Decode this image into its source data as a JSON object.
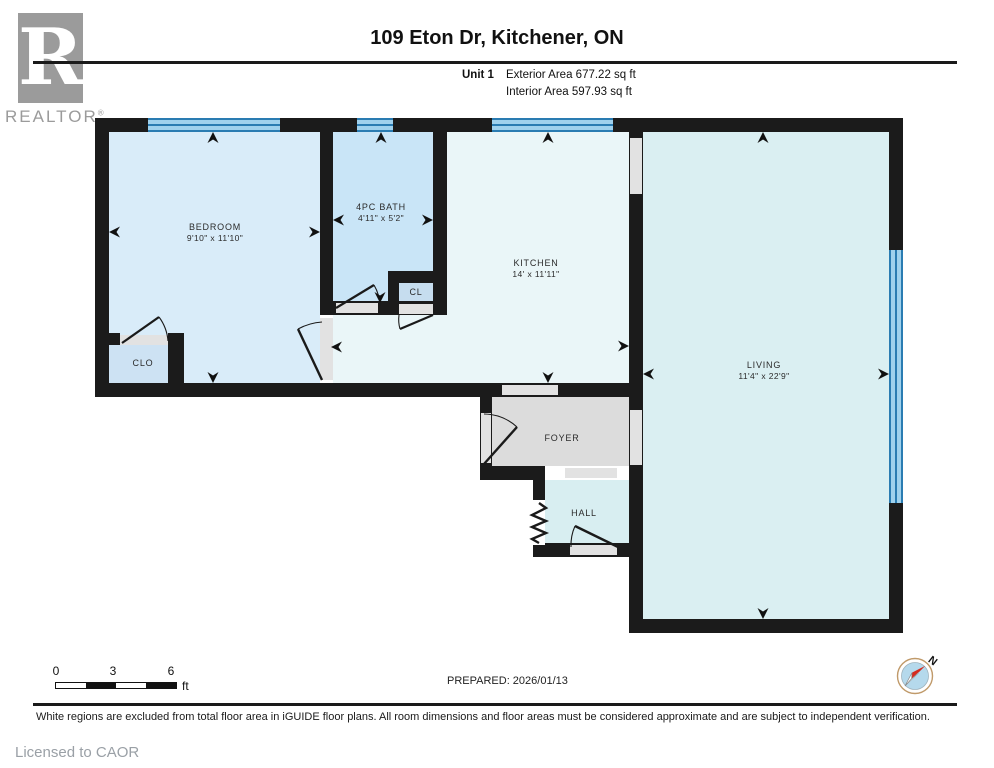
{
  "header": {
    "title": "109 Eton Dr, Kitchener, ON",
    "unit_label": "Unit 1",
    "exterior_area": "Exterior Area 677.22 sq ft",
    "interior_area": "Interior Area 597.93 sq ft",
    "logo_letter": "R",
    "logo_word": "REALTOR",
    "registered_mark": "®"
  },
  "rooms": {
    "bedroom": {
      "name": "BEDROOM",
      "dims": "9'10\" x 11'10\""
    },
    "bath": {
      "name": "4PC BATH",
      "dims": "4'11\" x 5'2\""
    },
    "kitchen": {
      "name": "KITCHEN",
      "dims": "14' x 11'11\""
    },
    "living": {
      "name": "LIVING",
      "dims": "11'4\" x 22'9\""
    },
    "foyer": {
      "name": "FOYER"
    },
    "hall": {
      "name": "HALL"
    },
    "closet_cl": {
      "name": "CL"
    },
    "closet_clo": {
      "name": "CLO"
    }
  },
  "footer": {
    "scale": {
      "tick0": "0",
      "tick1": "3",
      "tick2": "6",
      "unit": "ft"
    },
    "prepared": "PREPARED: 2026/01/13",
    "compass_north": "N",
    "disclaimer": "White regions are excluded from total floor area in iGUIDE floor plans. All room dimensions and floor areas must be considered approximate and are subject to independent verification.",
    "licensed": "Licensed to CAOR"
  },
  "colors": {
    "wall": "#1b1b1b",
    "window_fill": "#9fd1ed",
    "window_line": "#2a7cb2",
    "bedroom_fill": "#d9ecf9",
    "bath_fill": "#c9e5f7",
    "closet_fill": "#c6ddef",
    "kitchen_fill": "#eaf6f8",
    "living_fill": "#daeff2",
    "hall_fill": "#d8eef1",
    "foyer_excluded_fill": "#dcdcdc",
    "opening_fill": "#e2e2e2",
    "compass_needle_red": "#d42b1e",
    "compass_inner": "#b5d9ec",
    "logo_gray": "#9b9b9b"
  }
}
